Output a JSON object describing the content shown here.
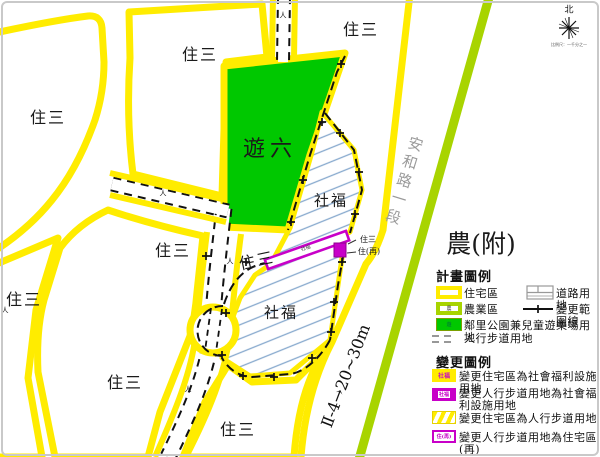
{
  "map": {
    "zones": {
      "residential": "住三",
      "park": "遊六",
      "welfare": "社福",
      "agriculture": "農(附)",
      "residential_re": "住(再)"
    },
    "road_name": "安和路一段",
    "road_dimension": "Ⅱ-4→20~30m",
    "north_label": "北",
    "scale_note": "比例尺：一千分之一",
    "pedestrian_mark": "人"
  },
  "legend_plan": {
    "title": "計畫圖例",
    "items": {
      "residential": "住宅區",
      "agriculture": "農業區",
      "agriculture_symbol": "農",
      "road": "道路用地",
      "change_boundary": "變更範圍線",
      "park": "鄰里公園兼兒童遊樂場用地",
      "walkway": "人行步道用地"
    }
  },
  "legend_change": {
    "title": "變更圖例",
    "items": [
      {
        "swatch_text": "社福",
        "label": "變更住宅區為社會福利設施用地"
      },
      {
        "swatch_text": "社福",
        "label": "變更人行步道用地為社會福利設施用地"
      },
      {
        "swatch_text": "",
        "label": "變更住宅區為人行步道用地"
      },
      {
        "swatch_text": "住(再)",
        "label": "變更人行步道用地為住宅區(再)"
      }
    ]
  },
  "colors": {
    "road_outline_yellow": "#ffec00",
    "park_green": "#00c800",
    "agriculture_lime": "#a8d400",
    "change_magenta": "#c800c8",
    "welfare_hatch_blue": "#88aace"
  }
}
